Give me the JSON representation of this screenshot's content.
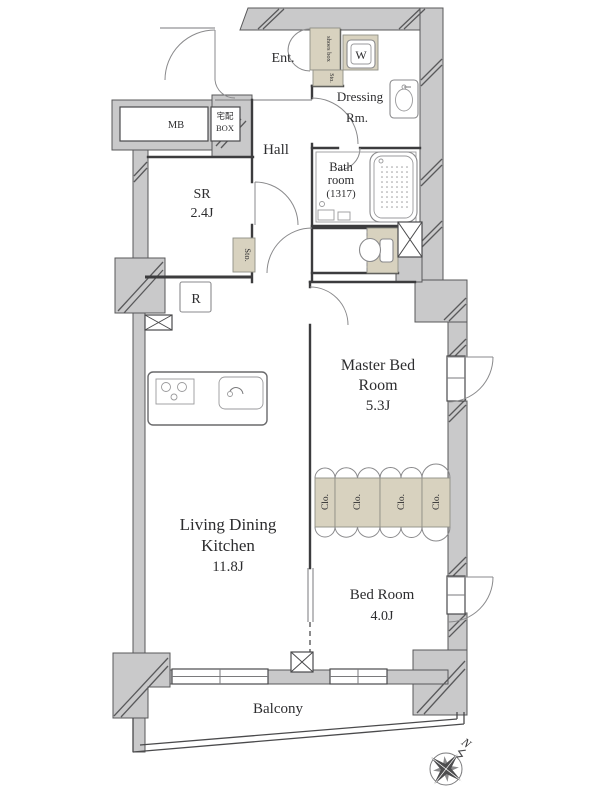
{
  "rooms": {
    "entrance": {
      "label": "Ent."
    },
    "hall": {
      "label": "Hall"
    },
    "dressing_room": {
      "lines": [
        "Dressing",
        "Rm."
      ]
    },
    "bathroom": {
      "lines": [
        "Bath",
        "room",
        "(1317)"
      ]
    },
    "service_room": {
      "lines": [
        "SR",
        "2.4J"
      ]
    },
    "master_bedroom": {
      "lines": [
        "Master Bed",
        "Room",
        "5.3J"
      ]
    },
    "living_dining_kitchen": {
      "lines": [
        "Living Dining",
        "Kitchen",
        "11.8J"
      ]
    },
    "bedroom": {
      "lines": [
        "Bed Room",
        "4.0J"
      ]
    },
    "balcony": {
      "label": "Balcony"
    }
  },
  "fixtures": {
    "shoes_box": "shoes box",
    "entrance_storage": "Sto.",
    "service_room_storage": "Sto.",
    "washer": "W",
    "closets": [
      "Clo.",
      "Clo.",
      "Clo.",
      "Clo."
    ],
    "meter_box": "MB",
    "delivery_box": [
      "宅配",
      "BOX"
    ],
    "refrigerator": "R"
  },
  "compass": {
    "north_label": "N"
  },
  "colors": {
    "wall_fill": "#c9c9ca",
    "storage_fill": "#d8d2bf",
    "line": "#3c3c3e",
    "text": "#2d2d2f"
  }
}
